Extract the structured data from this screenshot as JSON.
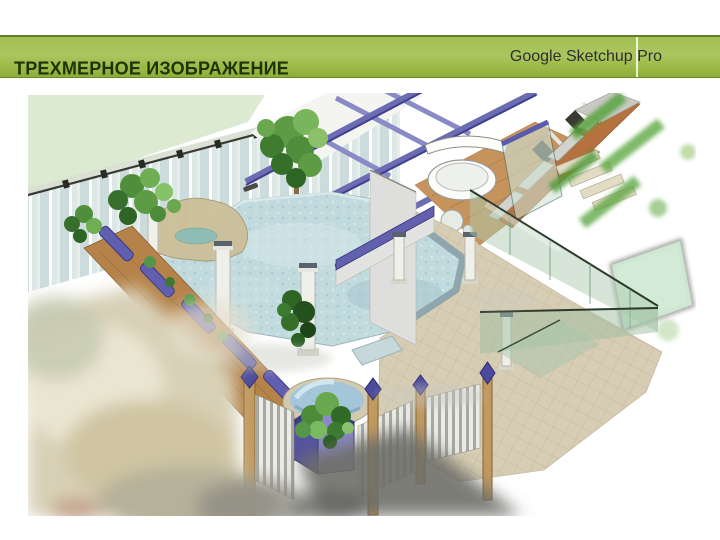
{
  "slide": {
    "title": "ТРЕХМЕРНОЕ ИЗОБРАЖЕНИЕ",
    "subtitle": "Google Sketchup Pro"
  },
  "header_colors": {
    "bar_gradient_top": "#a2bf52",
    "bar_gradient_bottom": "#8dac38",
    "bar_border_top": "#5e7d24",
    "title_color": "#1e3404",
    "subtitle_color": "#2e2e2e"
  },
  "rendering": {
    "description": "3D SketchUp model: indoor swimming-pool courtyard with white columns, tropical plants, tan tiled deck, purple planters and beams, green glass fencing, wooden perimeter wall and landscaped surroundings",
    "palette": {
      "pool_water": "#bfd9dd",
      "deck_tile": "#d7cdb4",
      "accent_purple": "#5c5aa8",
      "glass_green": "#b9d6bd",
      "wood": "#b5824a",
      "foliage_green": "#4f8f3c",
      "site_green": "#dcead2"
    }
  }
}
